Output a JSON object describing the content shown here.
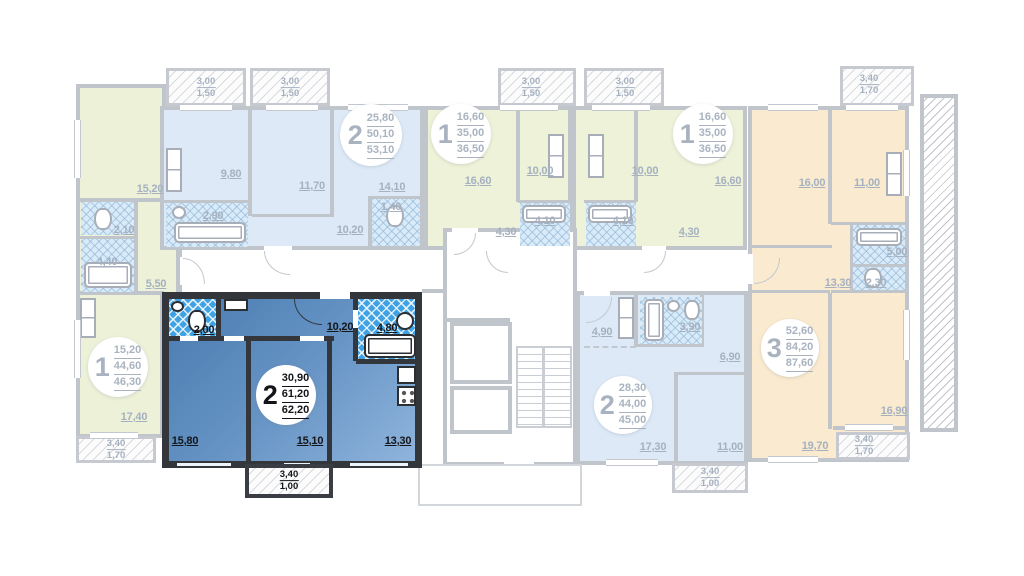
{
  "colors": {
    "highlight_fill": "#4a7bb0",
    "highlight_wall": "#33373c",
    "wet_bright": "#3ea2e4",
    "green_fill": "#ecf1d8",
    "blue_fill": "#dde9f6",
    "orange_fill": "#faeacf",
    "wall_gray": "#c0c5cc",
    "label_gray": "#a6b1c0",
    "label_dark": "#14161a"
  },
  "apartments": [
    {
      "id": "one-room-left",
      "badge": {
        "num": "1",
        "values": [
          "15,20",
          "44,60",
          "46,30"
        ]
      },
      "rooms": {
        "kitchen_living": "15,20",
        "wc": "2,10",
        "bath": "4,40",
        "hall": "5,50",
        "living": "17,40"
      },
      "balcony": {
        "top": "3,40",
        "bottom": "1,70"
      }
    },
    {
      "id": "two-room-top",
      "badge": {
        "num": "2",
        "values": [
          "25,80",
          "50,10",
          "53,10"
        ]
      },
      "rooms": {
        "kitchen": "9,80",
        "room_a": "11,70",
        "room_b": "14,10",
        "bath": "2,90",
        "wc": "1,40",
        "hall": "10,20"
      },
      "balcony_left": {
        "top": "3,00",
        "bottom": "1,50"
      },
      "balcony_right": {
        "top": "3,00",
        "bottom": "1,50"
      }
    },
    {
      "id": "one-room-mid-left",
      "badge": {
        "num": "1",
        "values": [
          "16,60",
          "35,00",
          "36,50"
        ]
      },
      "rooms": {
        "living": "16,60",
        "kitchen": "10,00",
        "bath": "4,10",
        "hall": "4,30"
      },
      "balcony": {
        "top": "3,00",
        "bottom": "1,50"
      }
    },
    {
      "id": "one-room-mid-right",
      "badge": {
        "num": "1",
        "values": [
          "16,60",
          "35,00",
          "36,50"
        ]
      },
      "rooms": {
        "living": "16,60",
        "kitchen": "10,00",
        "bath": "4,10",
        "hall": "4,30"
      },
      "balcony": {
        "top": "3,00",
        "bottom": "1,50"
      }
    },
    {
      "id": "three-room-right",
      "badge": {
        "num": "3",
        "values": [
          "52,60",
          "84,20",
          "87,60"
        ]
      },
      "rooms": {
        "room_a": "16,00",
        "kitchen": "11,00",
        "bath": "5,00",
        "wc": "2,30",
        "hall": "13,30",
        "room_b": "19,70",
        "room_c": "16,90"
      },
      "balcony_top": {
        "top": "3,40",
        "bottom": "1,70"
      },
      "balcony_bottom": {
        "top": "3,40",
        "bottom": "1,70"
      }
    },
    {
      "id": "two-room-selected",
      "badge": {
        "num": "2",
        "values": [
          "30,90",
          "61,20",
          "62,20"
        ]
      },
      "rooms": {
        "wc": "2,00",
        "hall": "10,20",
        "bath": "4,80",
        "room_a": "15,80",
        "room_b": "15,10",
        "kitchen": "13,30"
      },
      "balcony": {
        "top": "3,40",
        "bottom": "1,00"
      }
    },
    {
      "id": "two-room-bottom",
      "badge": {
        "num": "2",
        "values": [
          "28,30",
          "44,00",
          "45,00"
        ]
      },
      "rooms": {
        "kitchen": "4,90",
        "bath": "3,90",
        "hall": "6,90",
        "living": "17,30",
        "room": "11,00"
      },
      "balcony": {
        "top": "3,40",
        "bottom": "1,00"
      }
    }
  ]
}
